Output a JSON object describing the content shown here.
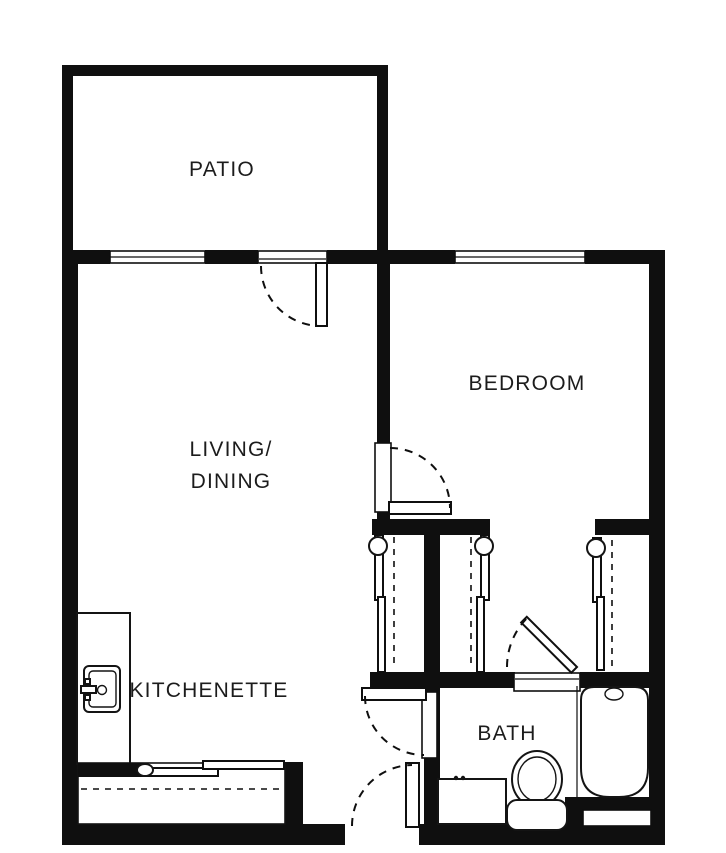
{
  "title": "Studio apartment floor plan",
  "colors": {
    "wall": "#0f0f0f",
    "background": "#ffffff",
    "text": "#1c1c1c"
  },
  "rooms": {
    "patio": {
      "label": "PATIO"
    },
    "living_dining": {
      "label_line1": "LIVING/",
      "label_line2": "DINING"
    },
    "bedroom": {
      "label": "BEDROOM"
    },
    "kitchenette": {
      "label": "KITCHENETTE"
    },
    "bath": {
      "label": "BATH"
    }
  },
  "fixtures": {
    "kitchen_sink": "kitchen-sink",
    "toilet": "toilet",
    "bathtub": "bathtub",
    "vanity": "bathroom-vanity",
    "kitchen_counter": "kitchen-counter",
    "wardrobe": "sliding-door-wardrobe"
  },
  "openings": {
    "windows": [
      "living-window",
      "bedroom-window",
      "bath-window"
    ],
    "doors": [
      "patio-door",
      "bedroom-door",
      "bath-hall-door",
      "bath-side-door",
      "entry-door"
    ],
    "closets": [
      "closet-left",
      "closet-middle",
      "closet-right"
    ]
  }
}
